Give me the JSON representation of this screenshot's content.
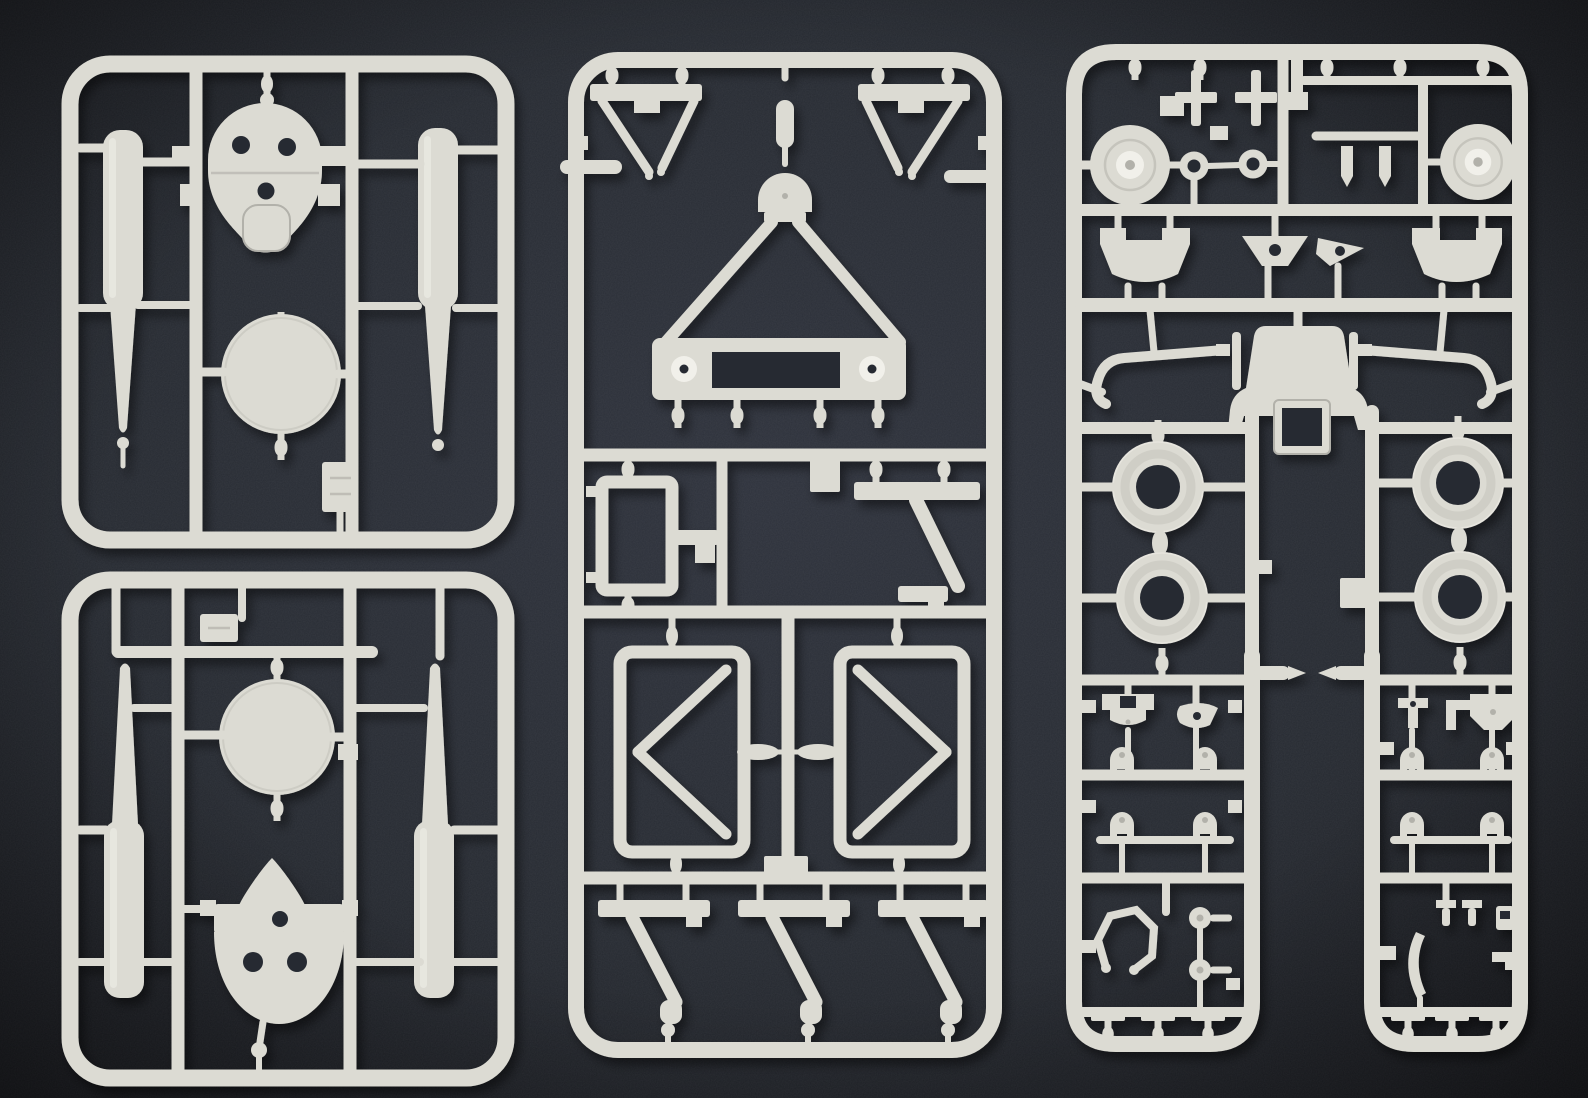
{
  "scene": {
    "kind": "photograph",
    "subject": "Light-gray injection-molded plastic model kit sprues laid on a dark textured mat",
    "sprue_count": 4
  },
  "colors": {
    "background": "#262a31",
    "background_edge": "#17181c",
    "plastic": "#dcdbd3",
    "plastic_shadow": "#b2b1aa",
    "plastic_highlight": "#f1f0ea",
    "hole": "#272b33"
  },
  "sprues": [
    {
      "id": "left-top",
      "parts": [
        "cowling-face-plate",
        "large-disc",
        "float-cylinder-left",
        "float-cylinder-right",
        "hatch-plate"
      ]
    },
    {
      "id": "left-bottom",
      "parts": [
        "hatch-plate",
        "large-disc",
        "float-cylinder-left",
        "float-cylinder-right",
        "cowling-face-plate-inverted"
      ]
    },
    {
      "id": "middle",
      "parts": [
        "v-strut-left",
        "v-strut-right",
        "pivot-capsule",
        "pivot-dome",
        "a-frame-with-base",
        "side-bar-left",
        "side-bar-right",
        "radiator-frame",
        "tag-plate",
        "z-bracket-upper",
        "x-braced-panel-left",
        "x-braced-panel-right",
        "tag-plate-lower",
        "z-strut-1",
        "z-strut-2",
        "z-strut-3"
      ]
    },
    {
      "id": "right",
      "parts": [
        "control-cross-1",
        "control-cross-2",
        "axle-rod",
        "wheel-hub-left",
        "small-ring-1",
        "small-ring-2",
        "bullet-peg-1",
        "bullet-peg-2",
        "wheel-hub-right",
        "bracket-panel-left",
        "funnel-plate",
        "arrow-plate",
        "bracket-panel-right",
        "curved-arm-left",
        "cowl-panel",
        "square-port-plate",
        "curved-arm-right",
        "tire-front-left",
        "tire-rear-left",
        "tire-front-right",
        "tire-rear-right",
        "inner-bullet-left",
        "inner-bullet-right",
        "u-bracket",
        "wing-clip",
        "y-clip",
        "l-clip",
        "pentagon-bracket",
        "bell-cover-row1-left",
        "bell-cover-row1-right",
        "bell-cover-row2-left",
        "bell-cover-row2-right",
        "horseshoe-ring",
        "disc-pin-upper",
        "disc-pin-lower",
        "pin-peg-1",
        "pin-peg-2",
        "side-clip",
        "curved-blade",
        "corner-clip",
        "t-peg-left-1",
        "t-peg-left-2",
        "t-peg-left-3",
        "t-peg-right-1",
        "t-peg-right-2",
        "t-peg-right-3"
      ]
    }
  ]
}
